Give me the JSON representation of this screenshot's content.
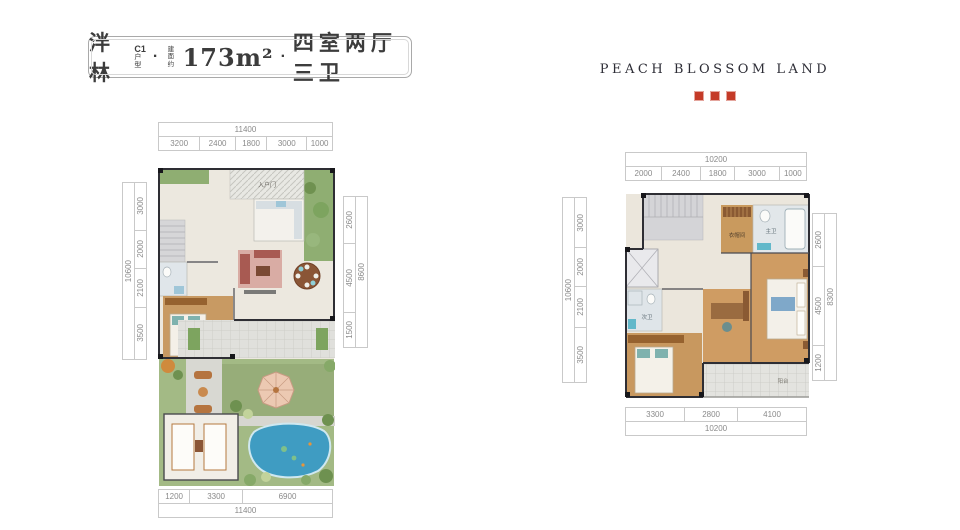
{
  "title_card": {
    "project_name": "泮林",
    "unit_code": "C1",
    "unit_code_sub": "户型",
    "separator": "·",
    "area_prefix": "建面约",
    "area_value": "173m²",
    "layout_desc": "四室两厅三卫"
  },
  "brand": {
    "name": "PEACH BLOSSOM LAND"
  },
  "floor1": {
    "dims": {
      "top_total": "11400",
      "top_segments": [
        "3200",
        "2400",
        "1800",
        "3000",
        "1000"
      ],
      "left_total": "10600",
      "left_segments": [
        "3000",
        "2000",
        "2100",
        "3500"
      ],
      "right_total": "8600",
      "right_segments": [
        "2600",
        "4500",
        "1500"
      ],
      "bottom_total": "11400",
      "bottom_segments": [
        "1200",
        "3300",
        "6900"
      ]
    },
    "labels": {
      "entry": "入户门"
    }
  },
  "floor2": {
    "dims": {
      "top_total": "10200",
      "top_segments": [
        "2000",
        "2400",
        "1800",
        "3000",
        "1000"
      ],
      "left_total": "10600",
      "left_segments": [
        "3000",
        "2000",
        "2100",
        "3500"
      ],
      "right_total": "8300",
      "right_segments": [
        "2600",
        "4500",
        "1200"
      ],
      "bottom_total": "10200",
      "bottom_segments": [
        "3300",
        "2800",
        "4100"
      ]
    },
    "labels": {
      "closet": "衣帽间",
      "master_bath": "主卫",
      "second_bath": "次卫",
      "balcony": "阳台"
    }
  }
}
